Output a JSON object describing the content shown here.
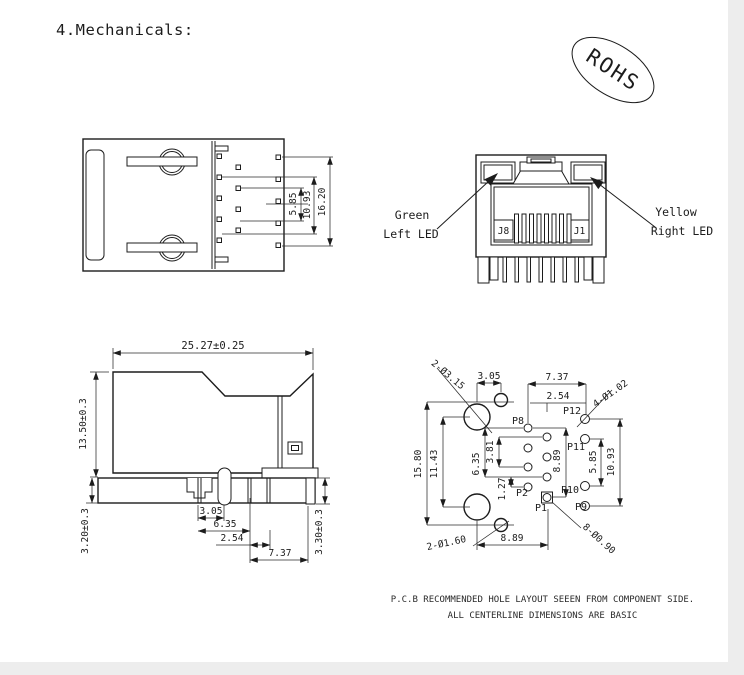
{
  "header": {
    "title": "4.Mechanicals:",
    "rohs": "ROHS"
  },
  "top_view": {
    "d585": "5.85",
    "d1093": "10.93",
    "d1620": "16.20"
  },
  "front_view": {
    "green1": "Green",
    "green2": "Left LED",
    "yellow1": "Yellow",
    "yellow2": "Right LED",
    "j8": "J8",
    "j1": "J1"
  },
  "side_view": {
    "w": "25.27±0.25",
    "h": "13.50±0.3",
    "standoff": "3.20±0.3",
    "peg": "3.30±0.3",
    "d305": "3.05",
    "d635": "6.35",
    "d254": "2.54",
    "d737": "7.37"
  },
  "pcb": {
    "d1580": "15.80",
    "d1143": "11.43",
    "d635": "6.35",
    "d381": "3.81",
    "d127": "1.27",
    "d889v": "8.89",
    "d585": "5.85",
    "d1093": "10.93",
    "d305": "3.05",
    "d737": "7.37",
    "d254": "2.54",
    "d889h": "8.89",
    "hole_big": "2-Ø3.15",
    "hole_small": "2-Ø1.60",
    "hole_led": "4-Ø1.02",
    "hole_signal": "8-Ø0.90",
    "p1": "P1",
    "p2": "P2",
    "p8": "P8",
    "p9": "P9",
    "p10": "P10",
    "p11": "P11",
    "p12": "P12"
  },
  "notes": {
    "line1": "P.C.B RECOMMENDED HOLE LAYOUT SEEEN FROM COMPONENT SIDE.",
    "line2": "ALL CENTERLINE DIMENSIONS ARE BASIC"
  }
}
